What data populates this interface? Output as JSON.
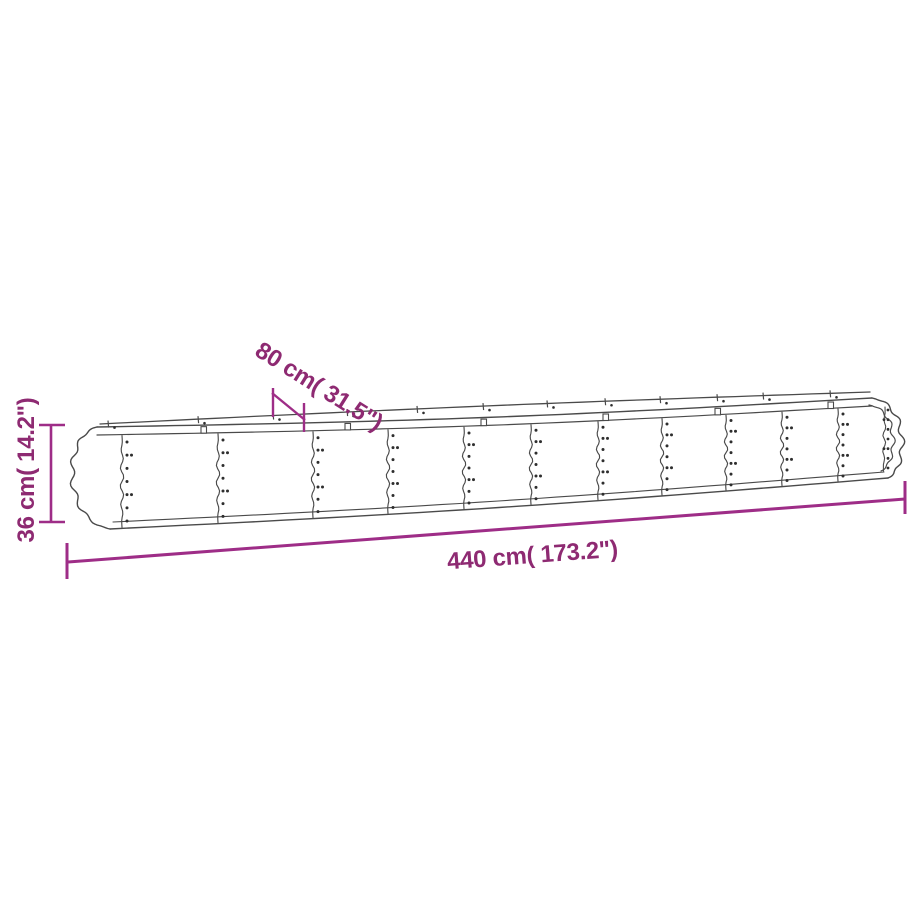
{
  "page": {
    "background": "#ffffff"
  },
  "diagram": {
    "colors": {
      "dimension_line": "#9e2d87",
      "dimension_text": "#8e2a72",
      "drawing_line": "#4a4a4a"
    },
    "dimensions": {
      "height": {
        "label": "36 cm( 14.2\")",
        "cm": "36",
        "inch": "14.2"
      },
      "width": {
        "label": "80 cm( 31.5\")",
        "cm": "80",
        "inch": "31.5"
      },
      "length": {
        "label": "440 cm( 173.2\")",
        "cm": "440",
        "inch": "173.2"
      }
    }
  }
}
